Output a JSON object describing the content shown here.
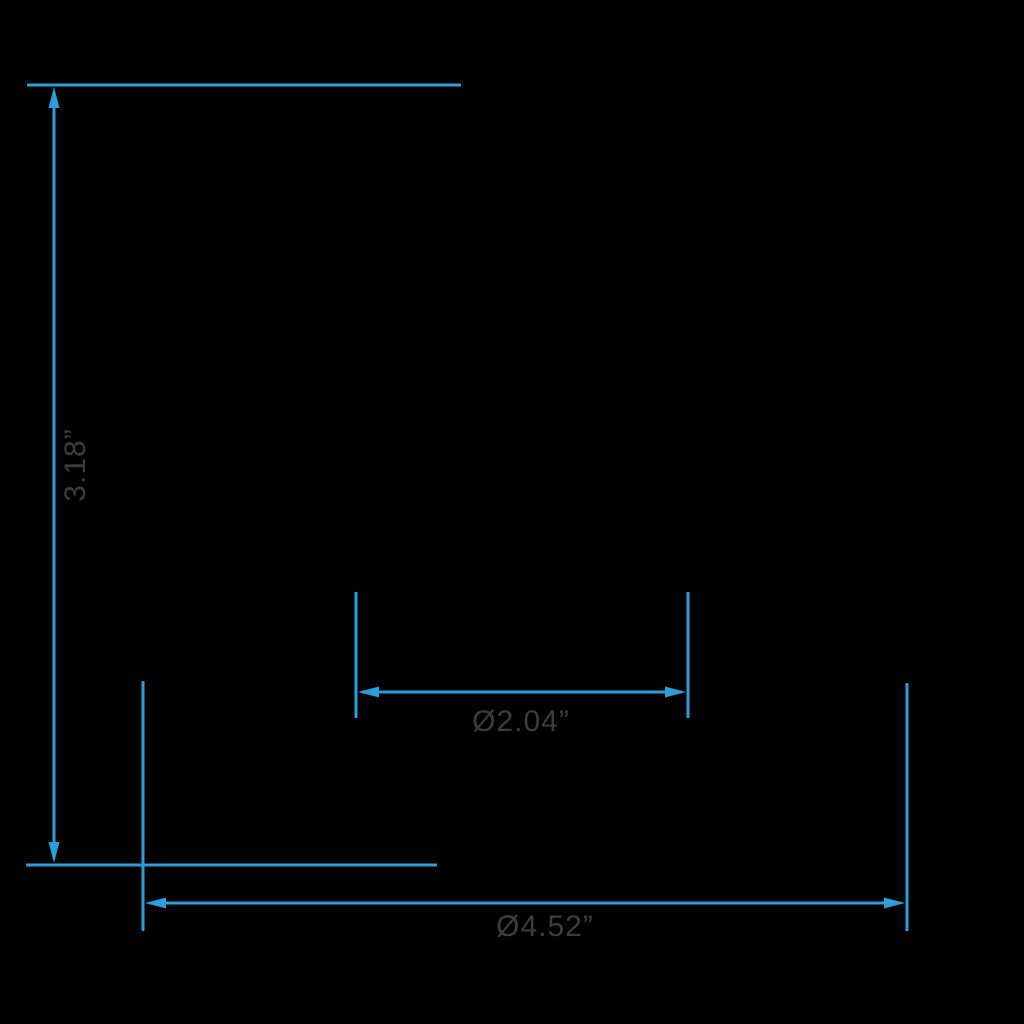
{
  "diagram": {
    "type": "product-dimension-drawing",
    "background_color": "#000000",
    "colors": {
      "dimension_blue": "#2B9FD8",
      "label_gray": "#3D3D3F"
    },
    "dimensions": {
      "height": {
        "label": "3.18”",
        "orientation": "vertical"
      },
      "inner_diameter": {
        "label": "Ø2.04”",
        "orientation": "horizontal"
      },
      "outer_diameter": {
        "label": "Ø4.52”",
        "orientation": "horizontal"
      }
    }
  }
}
